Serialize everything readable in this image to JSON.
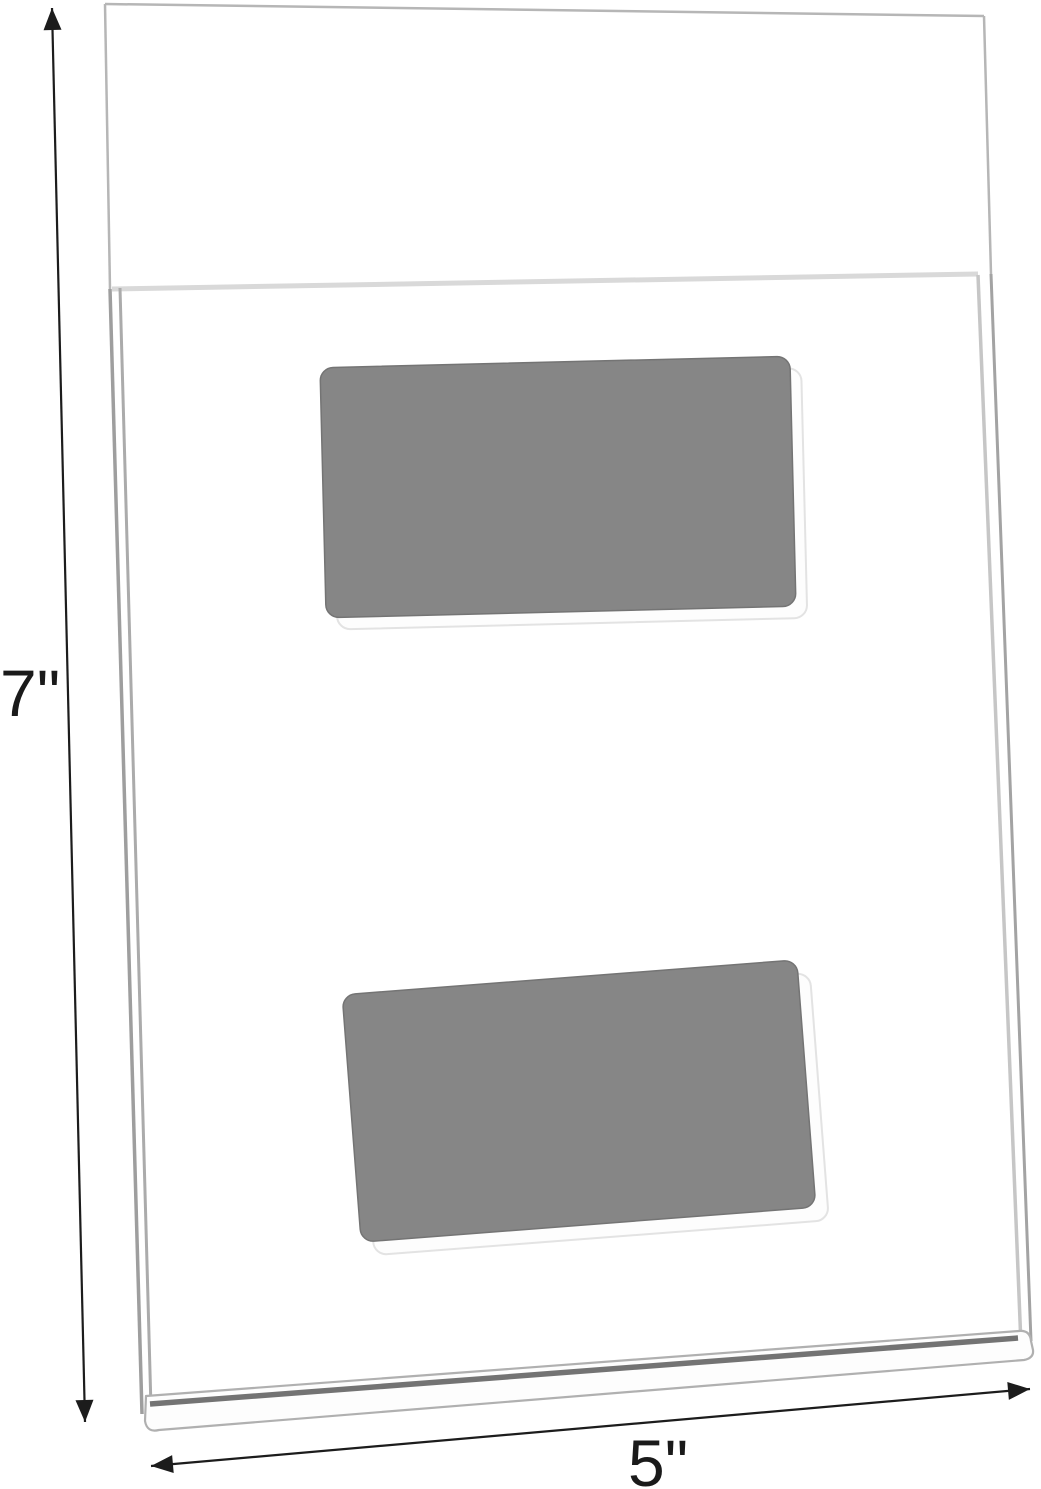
{
  "annotations": {
    "height_label": "7\"",
    "width_label": "5\""
  },
  "product": {
    "back_panel_label": "clear-acrylic-back-panel",
    "front_pocket_label": "clear-acrylic-front-pocket",
    "bottom_lip_label": "bottom-lip-edge",
    "adhesive_pads_count": 2
  },
  "colors": {
    "background": "#ffffff",
    "pad_fill": "#868686",
    "pad_stroke": "#747474",
    "pad_shadow_fill": "#fdfdfd",
    "pad_shadow_stroke": "#e3e3e3",
    "panel_edge_light": "#d9d9d9",
    "panel_edge_mid": "#a8a8a8",
    "panel_edge_dark": "#737373",
    "dimension_line": "#1c1c1c",
    "label_text": "#1a1a1a"
  }
}
